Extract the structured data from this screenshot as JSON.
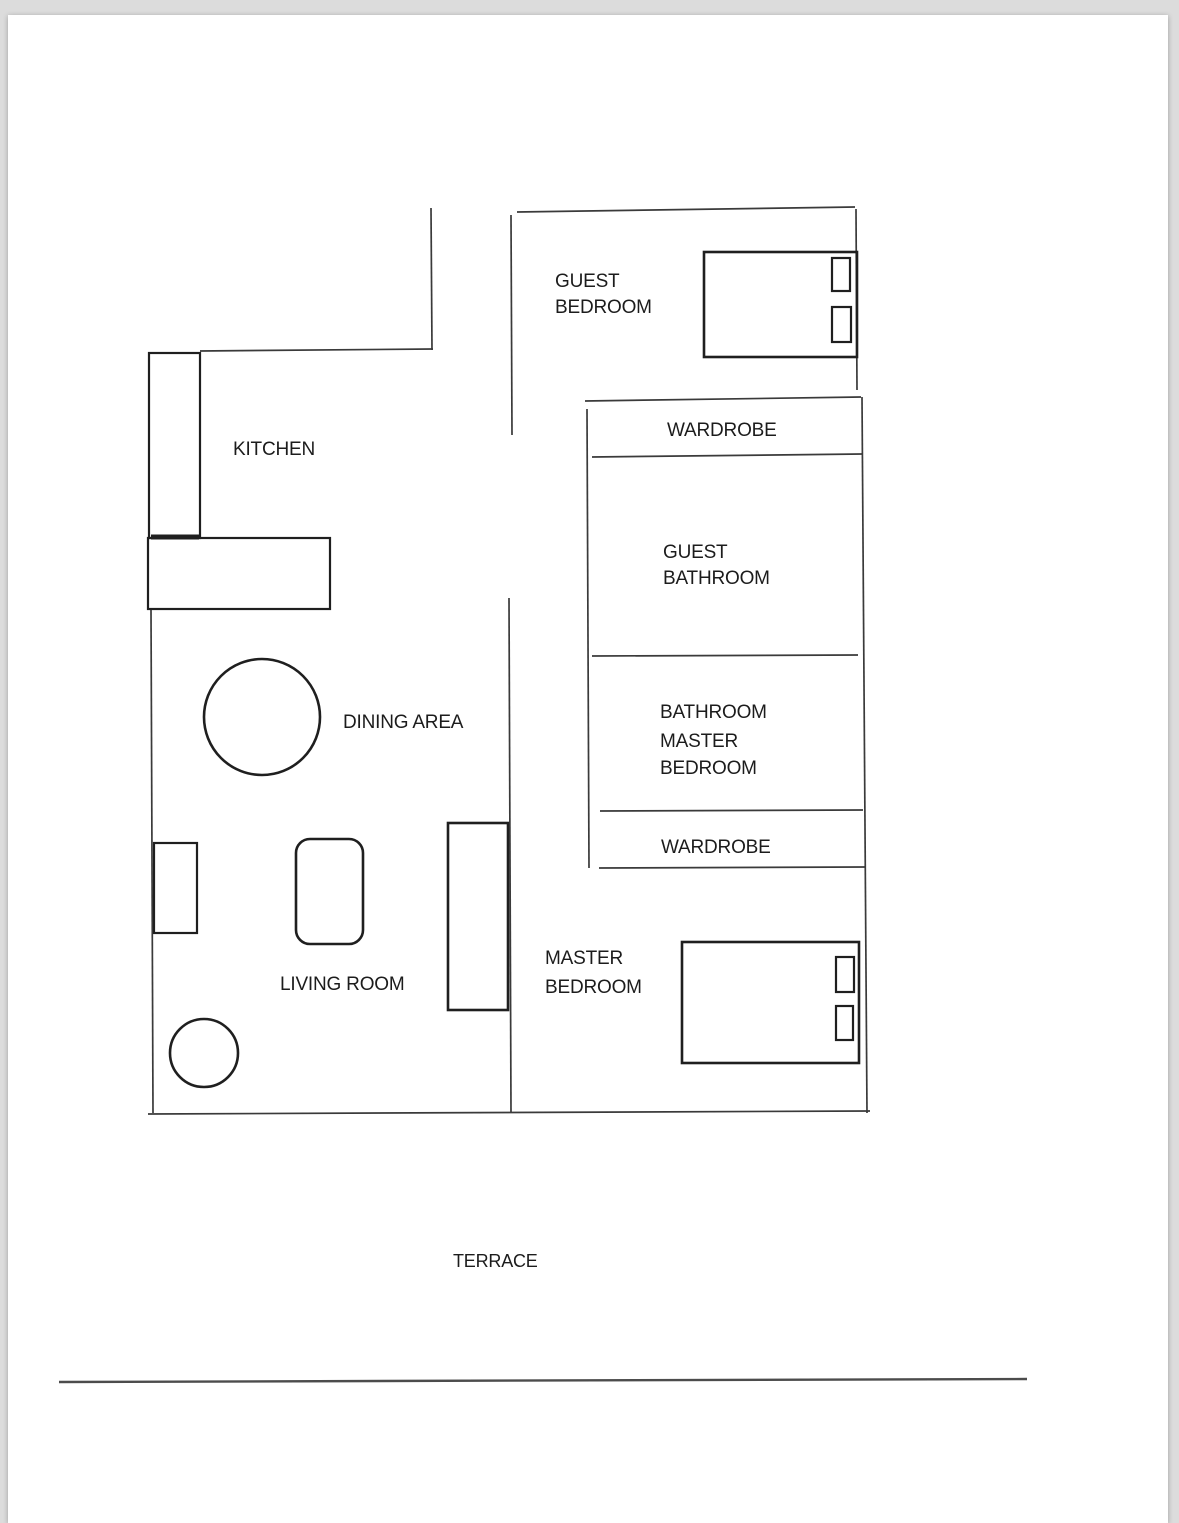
{
  "document": {
    "type": "floor-plan",
    "page_color": "#ffffff",
    "background_color": "#dcdcdc",
    "line_color": "#3a3a3a",
    "text_color": "#1c1c1c"
  },
  "rooms": {
    "guest_bedroom": {
      "line1": "GUEST",
      "line2": "BEDROOM"
    },
    "kitchen": {
      "label": "KITCHEN"
    },
    "wardrobe_top": {
      "label": "WARDROBE"
    },
    "guest_bathroom": {
      "line1": "GUEST",
      "line2": "BATHROOM"
    },
    "master_bathroom": {
      "line1": "BATHROOM",
      "line2": "MASTER",
      "line3": "BEDROOM"
    },
    "wardrobe_bottom": {
      "label": "WARDROBE"
    },
    "dining_area": {
      "label": "DINING AREA"
    },
    "living_room": {
      "label": "LIVING ROOM"
    },
    "master_bedroom": {
      "line1": "MASTER",
      "line2": "BEDROOM"
    },
    "terrace": {
      "label": "TERRACE"
    }
  },
  "furniture": [
    "guest-bed",
    "guest-bed-pillow-1",
    "guest-bed-pillow-2",
    "kitchen-counter-vertical",
    "kitchen-counter-horizontal",
    "dining-table-round",
    "armchair",
    "coffee-table",
    "sideboard",
    "side-table-round",
    "master-bed",
    "master-bed-pillow-1",
    "master-bed-pillow-2"
  ]
}
